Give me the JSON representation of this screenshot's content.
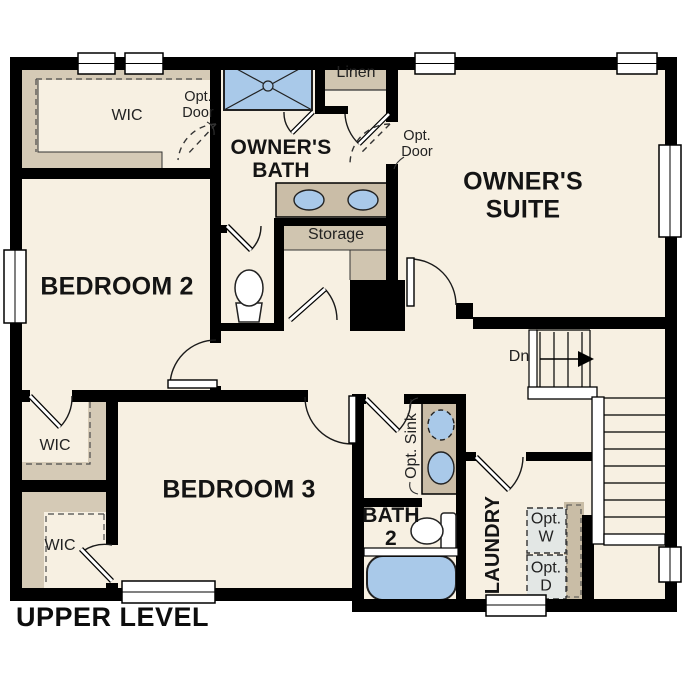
{
  "plan_title": "UPPER LEVEL",
  "rooms": {
    "owners_suite": "OWNER'S SUITE",
    "owners_bath": "OWNER'S BATH",
    "bedroom_2": "BEDROOM 2",
    "bedroom_3": "BEDROOM 3",
    "bath_2": "BATH 2",
    "laundry": "LAUNDRY"
  },
  "closets": {
    "wic_owner": "WIC",
    "wic_1": "WIC",
    "wic_2": "WIC",
    "linen": "Linen",
    "storage": "Storage"
  },
  "annotations": {
    "opt_door_1": "Opt. Door",
    "opt_door_2": "Opt. Door",
    "opt_sink": "Opt. Sink",
    "opt_washer": "Opt. W",
    "opt_dryer": "Opt. D",
    "stairs_down": "Dn"
  },
  "colors": {
    "wall": "#000000",
    "floor": "#f7f0e2",
    "closet_shading": "#d5cab6",
    "counter": "#cabda7",
    "fixture_blue": "#a9c9e9",
    "appliance": "#e3e7e5",
    "text": "#1c1c1c"
  }
}
